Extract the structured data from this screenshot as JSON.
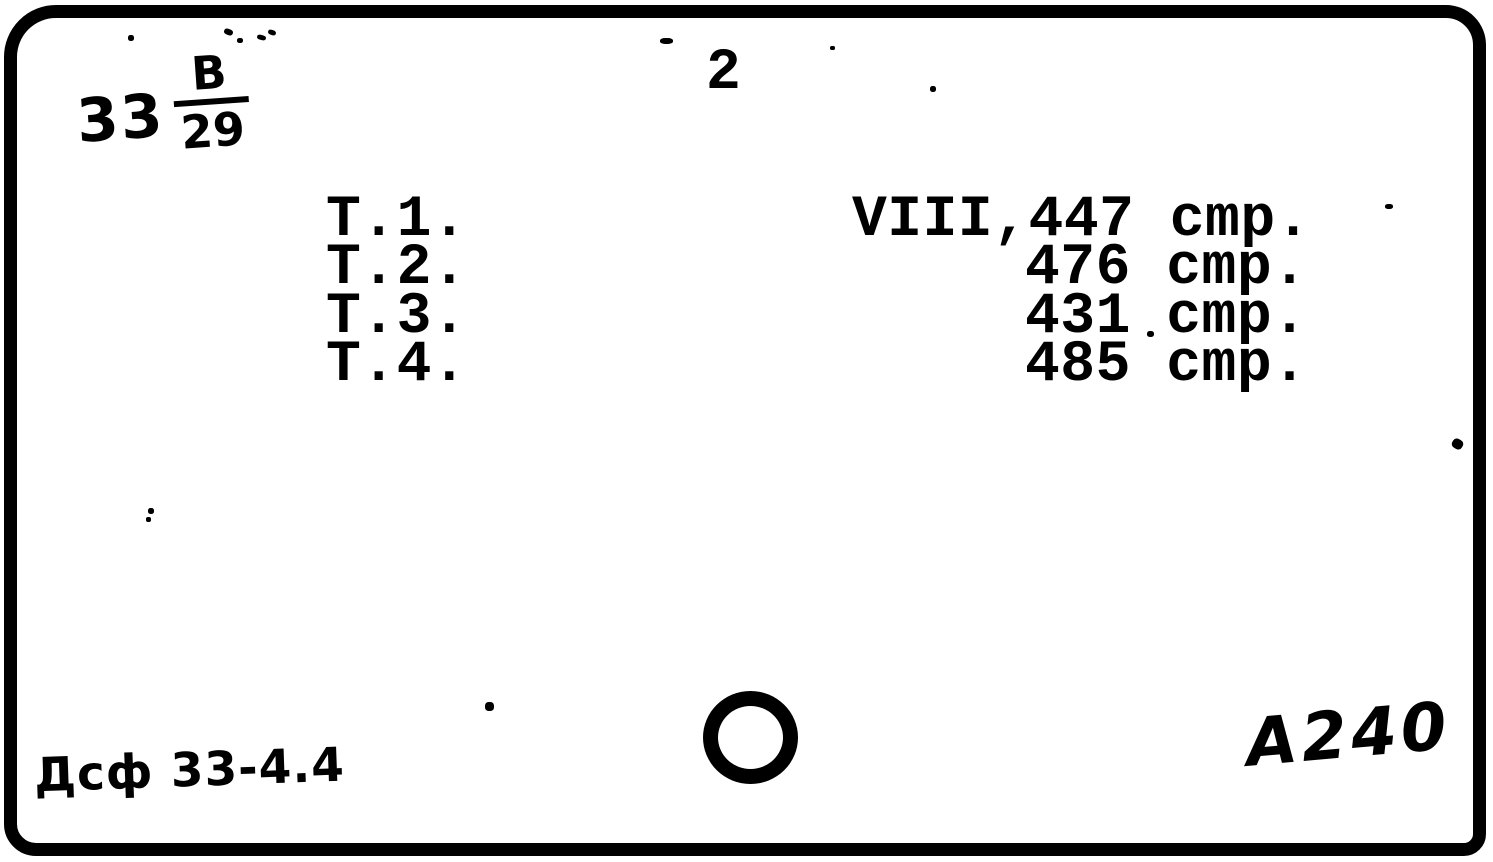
{
  "colors": {
    "ink": "#000000",
    "paper": "#ffffff"
  },
  "header": {
    "page_number": "2"
  },
  "call_number": {
    "class_number": "33",
    "author_letter": "В",
    "author_number": "29"
  },
  "volume_list": {
    "rows": [
      {
        "volume": "Т.1.",
        "pages": "VIII,447 cmp."
      },
      {
        "volume": "Т.2.",
        "pages": "476 cmp."
      },
      {
        "volume": "Т.3.",
        "pages": "431 cmp."
      },
      {
        "volume": "Т.4.",
        "pages": "485 cmp."
      }
    ]
  },
  "footer": {
    "bottom_left_note": "Дсф 33-4.4",
    "bottom_right_note": "А240"
  }
}
